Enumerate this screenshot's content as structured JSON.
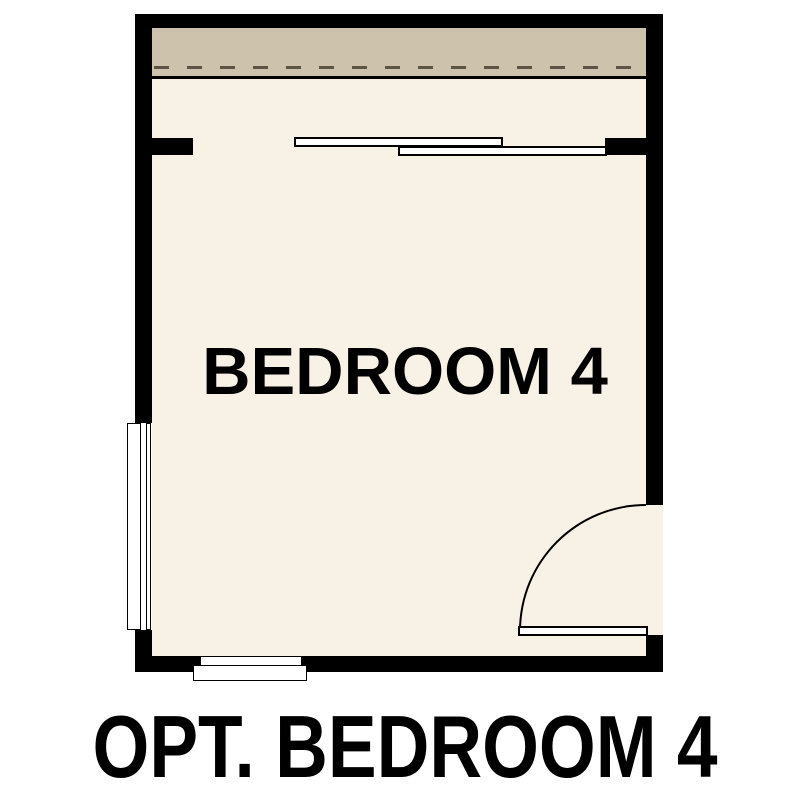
{
  "figure": {
    "room_label": "BEDROOM 4",
    "caption": "OPT. BEDROOM 4"
  },
  "colors": {
    "background": "#ffffff",
    "wall": "#000000",
    "floor": "#f8f1e5",
    "eave_strip": "#cdc3ad",
    "dash": "#5c5444",
    "fixture_fill": "#ffffff",
    "text": "#000000"
  },
  "symbols": {
    "top_strip": "roof-eave-overhang-with-dashed-line",
    "closet": "bypass-sliding-doors",
    "left_wall": "window",
    "bottom_wall": "window",
    "right_wall": "hinged-door-with-swing-arc"
  }
}
